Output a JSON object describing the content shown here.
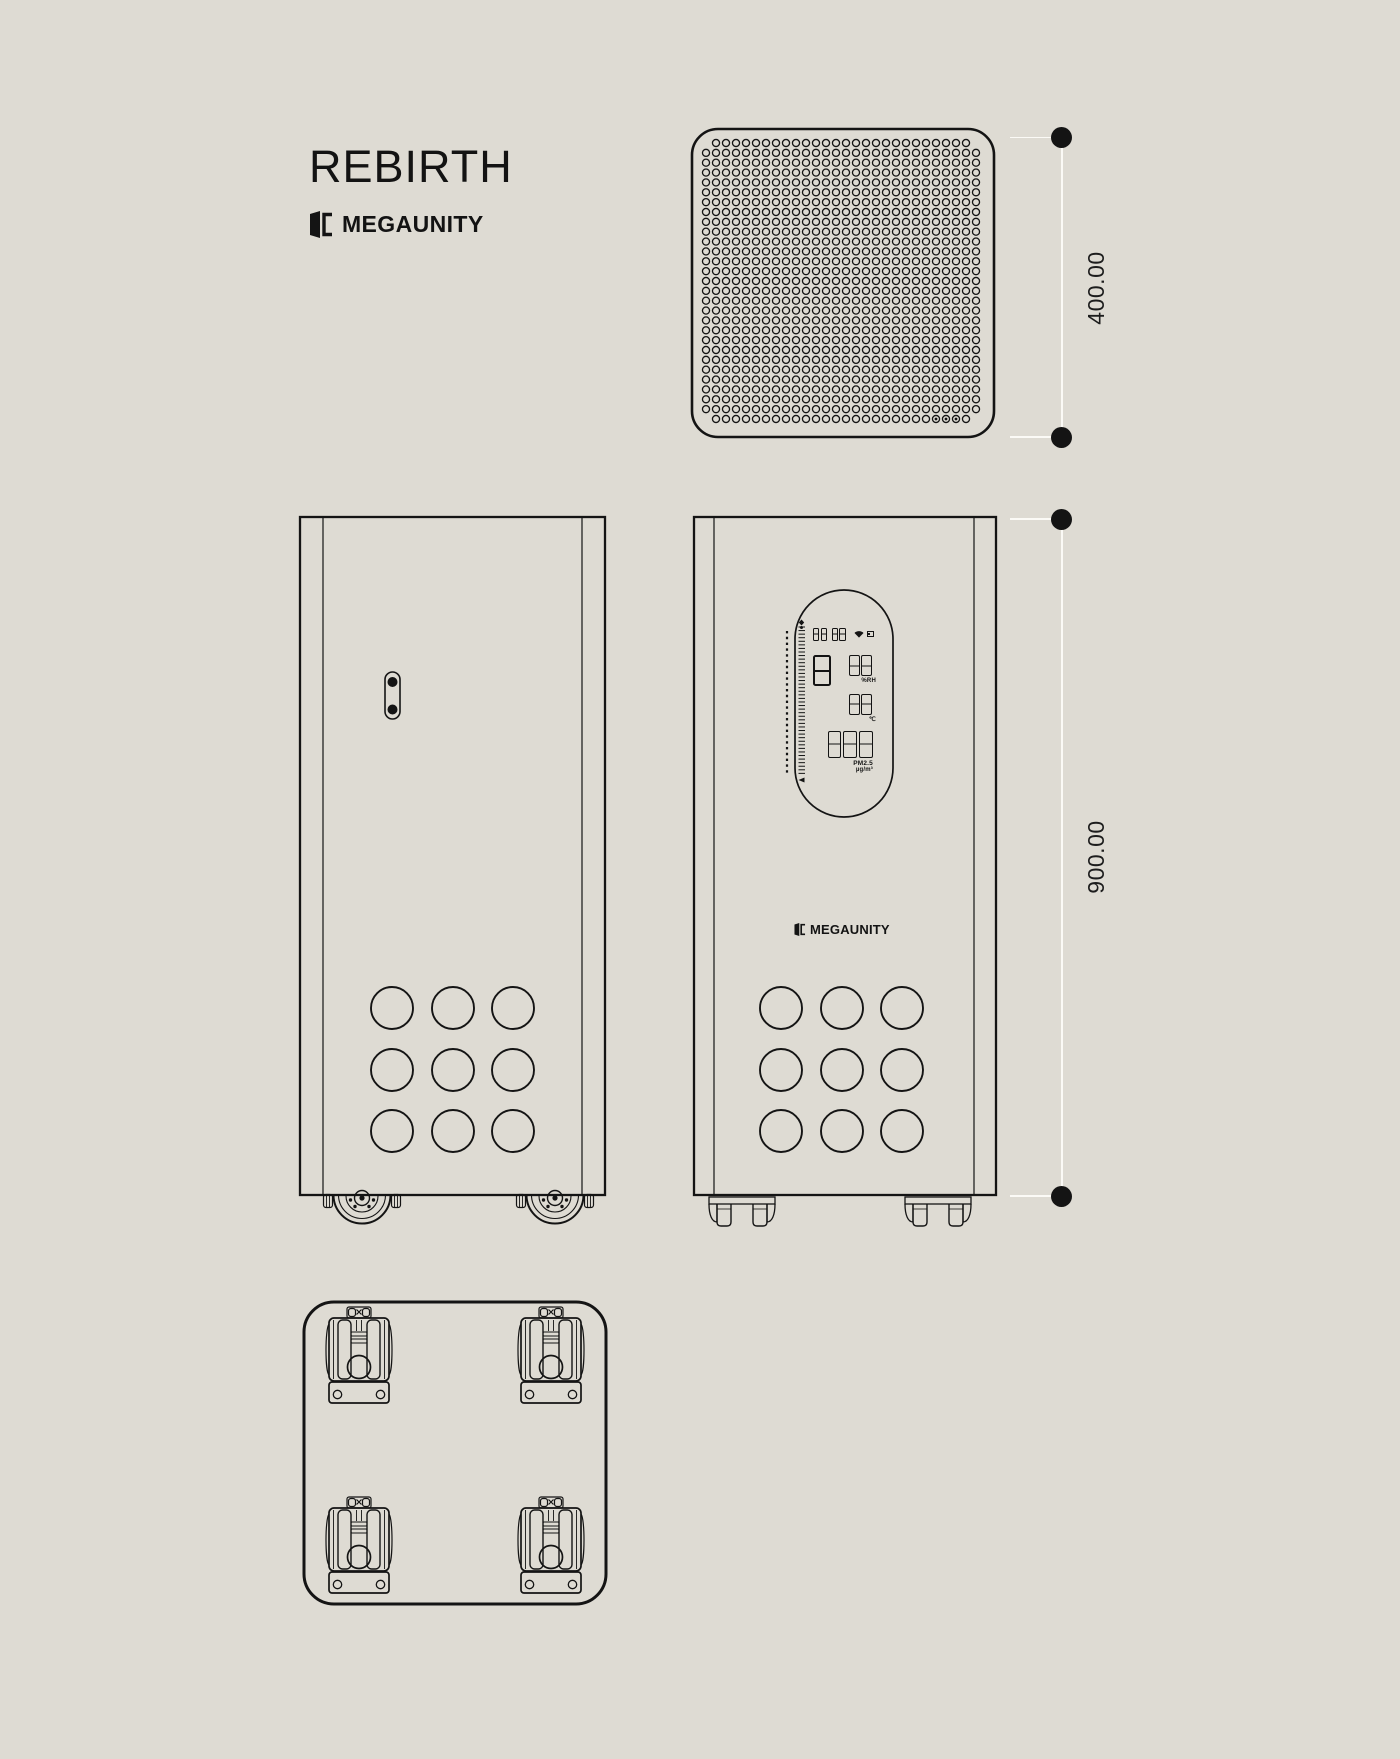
{
  "page": {
    "background": "#dedbd3",
    "line_color": "#141414",
    "dimension_line_color": "#fbfaf6"
  },
  "header": {
    "title": "REBIRTH",
    "brand": "MEGAUNITY",
    "logo_icon": "megaunity-logo-icon"
  },
  "dimensions": {
    "width": "400.00",
    "height": "900.00"
  },
  "drawing": {
    "views": {
      "top_view": {
        "label": "top-view",
        "perforation": {
          "cols": 28,
          "rows": 29,
          "hole_radius": 3.55,
          "screw_holes": 3
        }
      },
      "side_view": {
        "label": "side-view",
        "features": [
          "handle-slot",
          "vent-grid-3x3",
          "caster-wheels"
        ]
      },
      "front_view": {
        "label": "front-view",
        "brand": "MEGAUNITY",
        "display": {
          "clock": "88:88",
          "status_icons": [
            "wifi-icon",
            "battery-icon"
          ],
          "mode_digit": "8",
          "humidity": {
            "value": "88",
            "unit": "%RH"
          },
          "temperature": {
            "value": "88",
            "unit": "℃"
          },
          "pm25": {
            "value": "888",
            "label": "PM2.5",
            "unit": "µg/m³"
          }
        }
      },
      "bottom_view": {
        "label": "bottom-view",
        "features": [
          "caster",
          "caster",
          "caster",
          "caster"
        ]
      }
    }
  }
}
